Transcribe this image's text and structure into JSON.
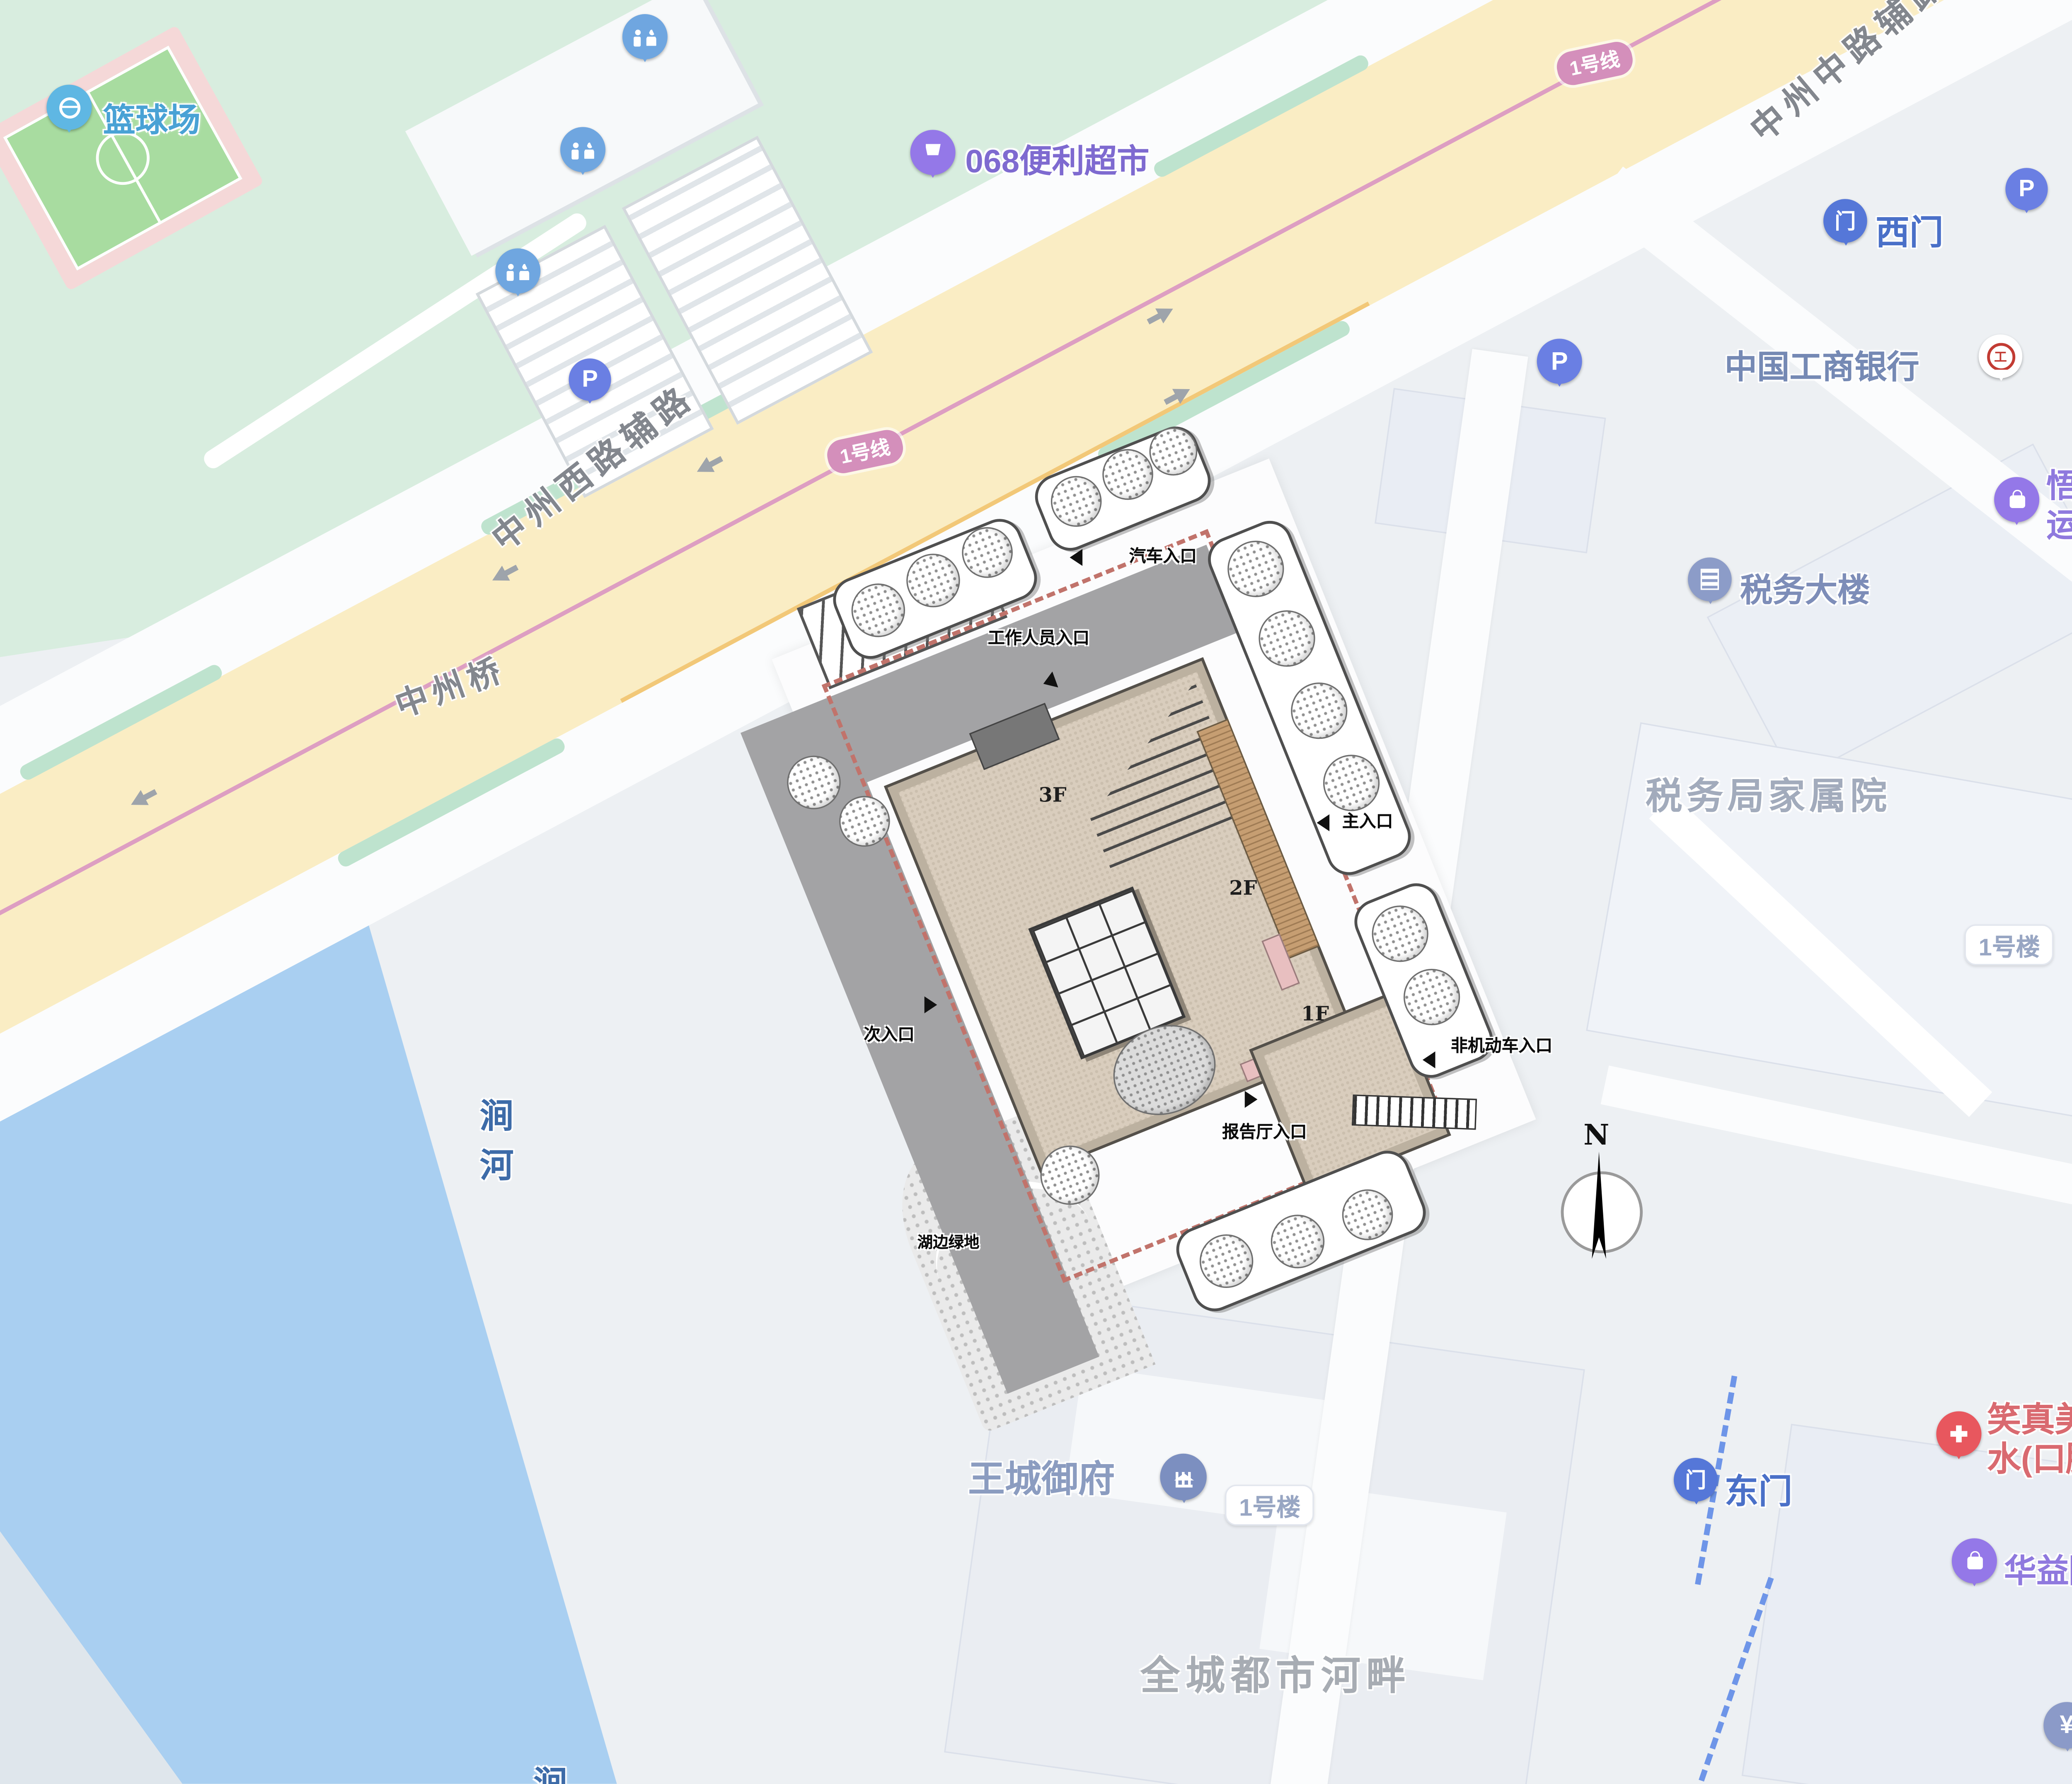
{
  "colors": {
    "water": "#A9CFF1",
    "park": "#D8EDDF",
    "court_green": "#A8DCA0",
    "court_pink": "#F5D8D8",
    "road_yellow": "#FAEDC4",
    "metro_pink": "#DD9EC2",
    "boundary_red": "#C1736B",
    "poi_blue": "#4A70C8",
    "poi_purple": "#8F79DE",
    "poi_muted": "#7D8DB8",
    "poi_red": "#D96A70",
    "gray_label": "#8C9096",
    "roof_tan": "#D9CDBD"
  },
  "roads": {
    "west_aux": "中州西路辅路",
    "bridge": "中州桥",
    "mid_aux": "中州中路辅路",
    "metro_badge": "1号线"
  },
  "pois": {
    "basketball": {
      "label": "篮球场"
    },
    "store": {
      "label": "068便利超市"
    },
    "west_gate": {
      "label": "西门"
    },
    "icbc": {
      "label": "中国工商银行"
    },
    "wine": {
      "line1": "悟伴酒庄",
      "line2": "运营中心"
    },
    "tax_building": {
      "label": "税务大楼"
    },
    "tax_compound": {
      "label": "税务局家属院"
    },
    "bldg1_right": {
      "label": "1号楼"
    },
    "bldg1_south": {
      "label": "1号楼"
    },
    "wangcheng": {
      "label": "王城御府"
    },
    "east_gate": {
      "label": "东门"
    },
    "clinic": {
      "line1": "笑真美长",
      "line2": "水(口腔)"
    },
    "ceramics": {
      "label": "华益陶瓷"
    },
    "bank": {
      "line1": "中国人",
      "line2": "(洛阳西"
    },
    "riverside": {
      "label": "全城都市河畔"
    },
    "guo_partial": {
      "label": "国"
    },
    "kao_partial": {
      "label": "烤"
    },
    "river": {
      "char1": "涧",
      "char2": "河"
    }
  },
  "site": {
    "entrances": {
      "car": "汽车入口",
      "staff": "工作人员入口",
      "main": "主入口",
      "secondary": "次入口",
      "non_motor": "非机动车入口",
      "hall": "报告厅入口"
    },
    "green_label": "湖边绿地",
    "floors": {
      "f3": "3F",
      "f2": "2F",
      "f1": "1F"
    },
    "compass": "N"
  },
  "icons": {
    "parking": "P",
    "yuan": "¥",
    "gate": "门",
    "icbc_mark": "工"
  }
}
